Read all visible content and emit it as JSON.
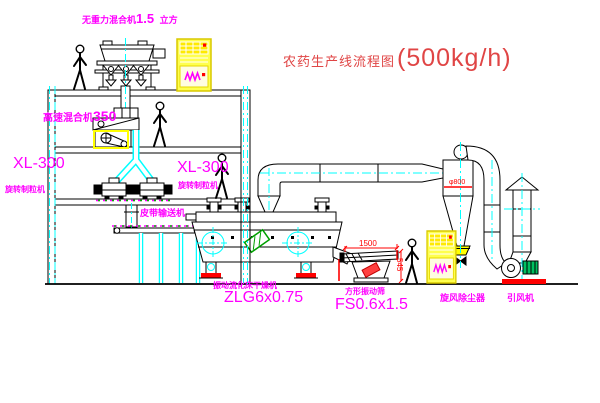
{
  "title": {
    "name": "农药生产线流程图",
    "capacity": "(500kg/h)"
  },
  "labels": {
    "gravity_mixer": {
      "name": "无重力混合机",
      "volume": "1.5",
      "unit": "立方"
    },
    "high_speed_mixer": {
      "name": "高速混合机",
      "model": "350"
    },
    "granulator_left": {
      "model": "XL-300",
      "name": "旋转制粒机"
    },
    "granulator_right": {
      "model": "XL-300",
      "name": "旋转制粒机"
    },
    "belt_conveyor": "皮带输送机",
    "dryer": {
      "name": "振动流化床干燥机",
      "model": "ZLG6x0.75"
    },
    "sieve": {
      "name": "方形振动筛",
      "model": "FS0.6x1.5"
    },
    "cyclone": "旋风除尘器",
    "fan": "引风机"
  },
  "dimensions": {
    "sieve_length": "1500",
    "sieve_height": "545",
    "cyclone_diameter": "φ800"
  },
  "colors": {
    "label": "#ff00ff",
    "title": "#e04545",
    "dimension": "#ff0000",
    "centerline": "#00ffff",
    "highlight": "#ffff00",
    "line": "#000000",
    "accent_green": "#00a000"
  }
}
